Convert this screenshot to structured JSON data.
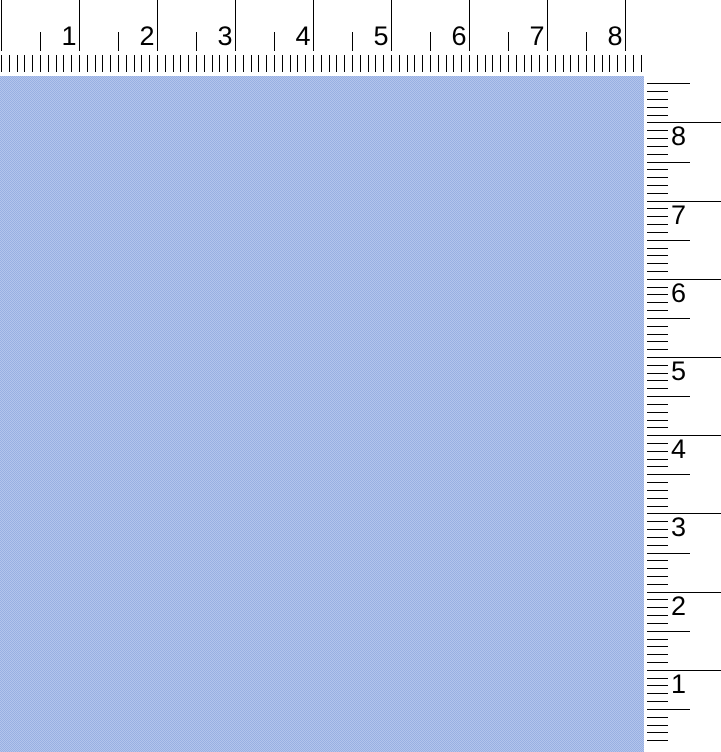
{
  "canvas": {
    "description": "blank canvas area with dithered light-blue texture",
    "fill_light": "#b3c4ec",
    "fill_dark": "#98b0e2"
  },
  "horizontal_ruler": {
    "orientation": "horizontal",
    "position": "top",
    "unit_labels": [
      "1",
      "2",
      "3",
      "4",
      "5",
      "6",
      "7",
      "8"
    ],
    "subdivisions_per_unit": 10,
    "tick_color": "#000000",
    "label_color": "#000000",
    "background": "#ffffff"
  },
  "vertical_ruler": {
    "orientation": "vertical",
    "position": "right",
    "unit_labels": [
      "8",
      "7",
      "6",
      "5",
      "4",
      "3",
      "2",
      "1"
    ],
    "subdivisions_per_unit": 10,
    "tick_color": "#000000",
    "label_color": "#000000",
    "background": "#ffffff"
  }
}
